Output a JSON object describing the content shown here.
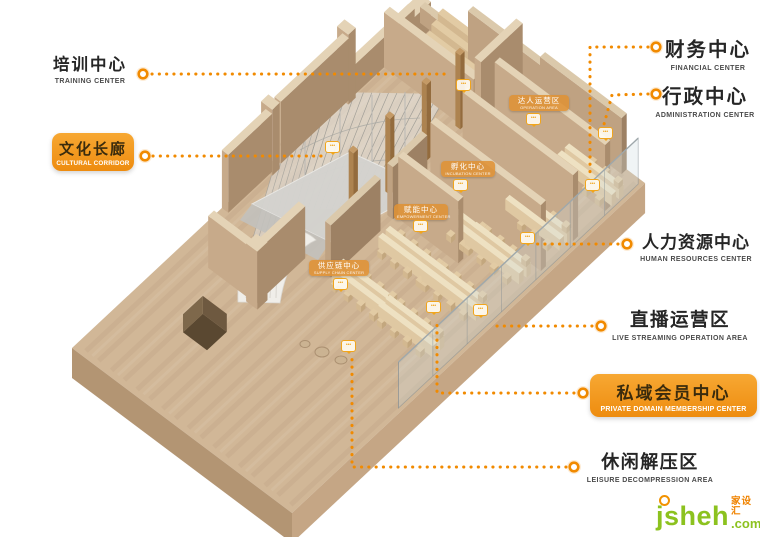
{
  "labels": {
    "training": {
      "zh": "培训中心",
      "en": "TRAINING CENTER"
    },
    "cultural": {
      "zh": "文化长廊",
      "en": "CULTURAL CORRIDOR"
    },
    "financial": {
      "zh": "财务中心",
      "en": "FINANCIAL CENTER"
    },
    "admin": {
      "zh": "行政中心",
      "en": "ADMINISTRATION CENTER"
    },
    "hr": {
      "zh": "人力资源中心",
      "en": "HUMAN RESOURCES CENTER"
    },
    "live": {
      "zh": "直播运营区",
      "en": "LIVE STREAMING OPERATION AREA"
    },
    "private": {
      "zh": "私域会员中心",
      "en": "PRIVATE DOMAIN MEMBERSHIP CENTER"
    },
    "leisure": {
      "zh": "休闲解压区",
      "en": "LEISURE DECOMPRESSION AREA"
    }
  },
  "area_tags": {
    "talent": {
      "zh": "达人运营区",
      "en": "OPERATION AREA"
    },
    "incubation": {
      "zh": "孵化中心",
      "en": "INCUBATION CENTER"
    },
    "empower": {
      "zh": "赋能中心",
      "en": "EMPOWERMENT CENTER"
    },
    "supply": {
      "zh": "供应链中心",
      "en": "SUPPLY CHAIN CENTER"
    }
  },
  "watermark": {
    "site": "jsheh",
    "tld": ".com",
    "zh": "家设汇"
  },
  "colors": {
    "accent_orange": "#f18a00",
    "label_box_orange": "#f5a02a",
    "wood_floor": "#d1b797",
    "watermark_green": "#8cc21f"
  }
}
